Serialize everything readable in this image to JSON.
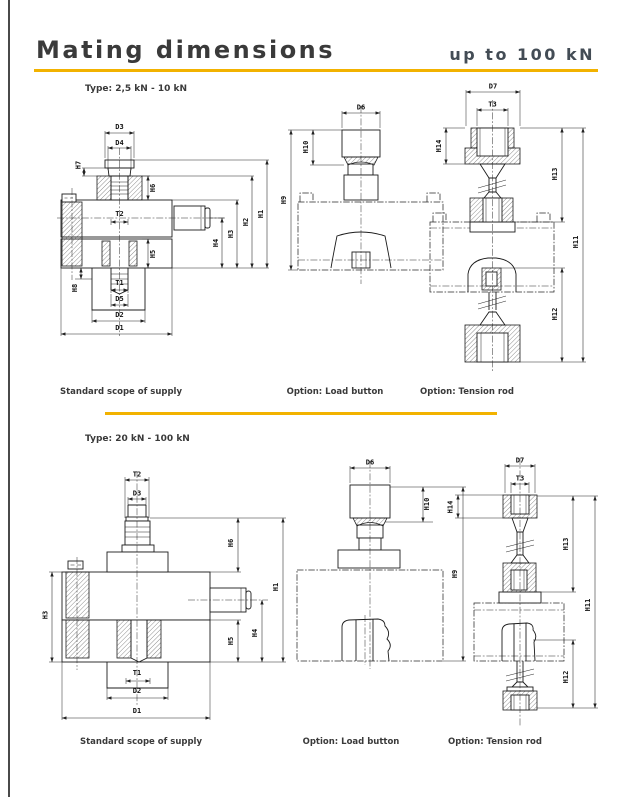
{
  "page": {
    "title": "Mating dimensions",
    "subtitle": "up to 100 kN",
    "accent_color": "#F2B200",
    "sections": [
      {
        "type_label": "Type: 2,5 kN - 10 kN",
        "captions": [
          "Standard scope of supply",
          "Option: Load button",
          "Option: Tension rod"
        ]
      },
      {
        "type_label": "Type: 20 kN - 100 kN",
        "captions": [
          "Standard scope of supply",
          "Option: Load button",
          "Option: Tension rod"
        ]
      }
    ]
  },
  "drawings": {
    "s1_standard": {
      "labels": {
        "d3": "D3",
        "d4": "D4",
        "h7": "H7",
        "h6": "H6",
        "t2": "T2",
        "h5": "H5",
        "h8": "H8",
        "t1": "T1",
        "d5": "D5",
        "d2": "D2",
        "d1": "D1",
        "h4": "H4",
        "h3": "H3",
        "h2": "H2",
        "h1": "H1"
      }
    },
    "s1_button": {
      "labels": {
        "d6": "D6",
        "h10": "H10",
        "h9": "H9"
      }
    },
    "s1_rod": {
      "labels": {
        "d7": "D7",
        "t3": "T3",
        "h14": "H14",
        "h13": "H13",
        "h11": "H11",
        "h12": "H12"
      }
    },
    "s2_standard": {
      "labels": {
        "t2": "T2",
        "d3": "D3",
        "h6": "H6",
        "h3": "H3",
        "h5": "H5",
        "h4": "H4",
        "h1": "H1",
        "t1": "T1",
        "d2": "D2",
        "d1": "D1"
      }
    },
    "s2_button": {
      "labels": {
        "d6": "D6",
        "h10": "H10",
        "h9": "H9"
      }
    },
    "s2_rod": {
      "labels": {
        "d7": "D7",
        "t3": "T3",
        "h14": "H14",
        "h13": "H13",
        "h11": "H11",
        "h12": "H12"
      }
    }
  }
}
